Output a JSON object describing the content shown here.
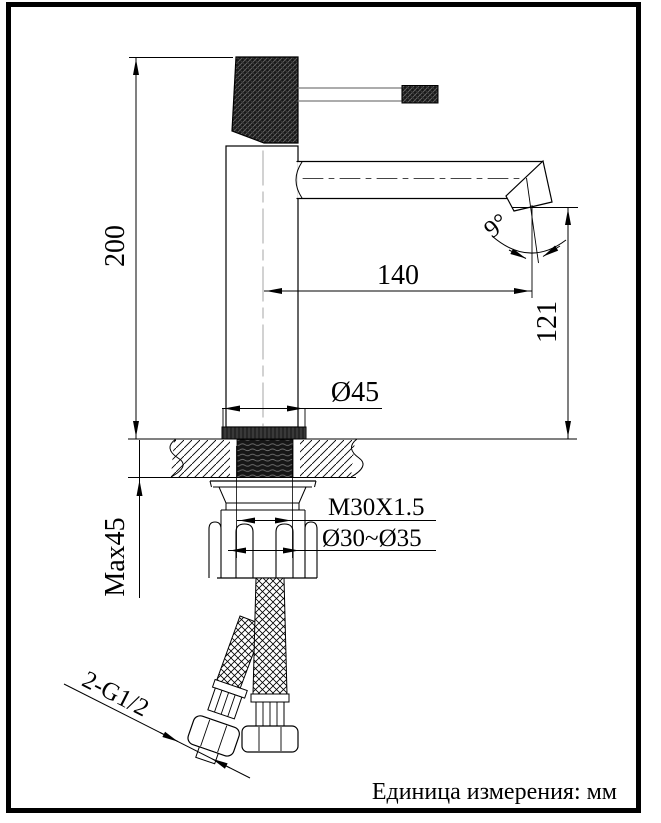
{
  "drawing": {
    "kind": "faucet installation dimension drawing",
    "labels": {
      "height_total": "200",
      "spout_reach": "140",
      "outlet_height": "121",
      "base_diameter": "Ø45",
      "max_mounting_thickness": "Max45",
      "thread_spec": "M30X1.5",
      "mounting_hole_diameter": "Ø30~Ø35",
      "hose_thread": "2-G1/2",
      "spout_angle": "9°"
    },
    "footer": {
      "unit_note": "Единица измерения: мм"
    },
    "colors": {
      "outline": "#000000",
      "centerline": "#b3b3b3",
      "background": "#ffffff",
      "frame": "#000000"
    }
  }
}
